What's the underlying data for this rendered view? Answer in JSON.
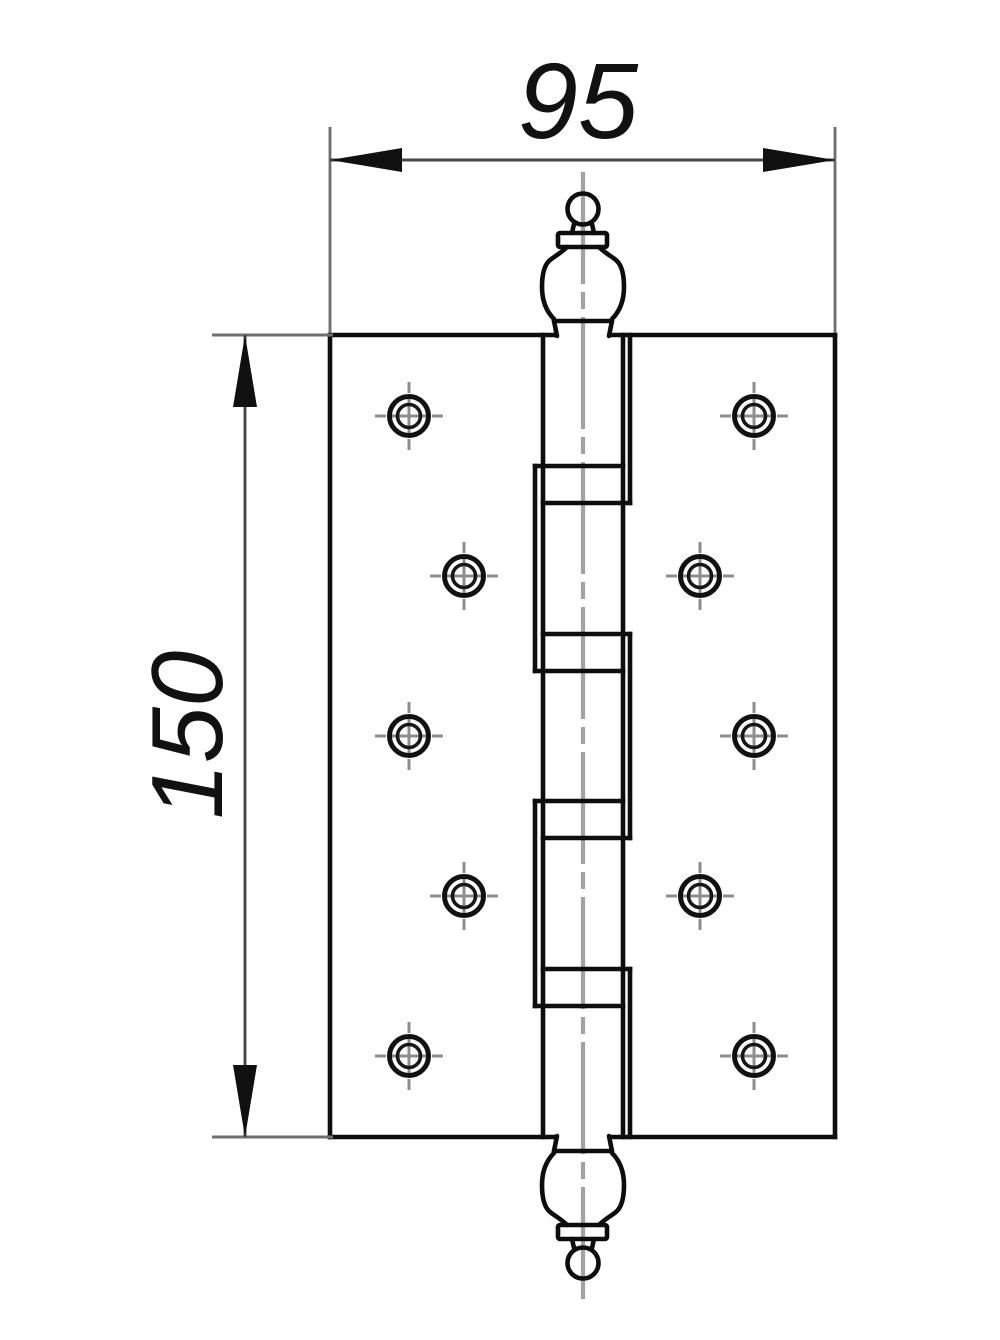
{
  "drawing": {
    "kind": "door-hinge-front-view",
    "screw_hole_count": 10,
    "knuckle_count": 5,
    "bearing_band_count": 4
  },
  "dimensions": {
    "width": {
      "label": "95"
    },
    "height": {
      "label": "150"
    }
  },
  "colors": {
    "background": "#ffffff",
    "outline": "#0d0d0d",
    "dimension_line": "#474747",
    "extension_line": "#6f6f6f",
    "centerline": "#a2a2a2",
    "crosshair": "#8d8d8d"
  }
}
